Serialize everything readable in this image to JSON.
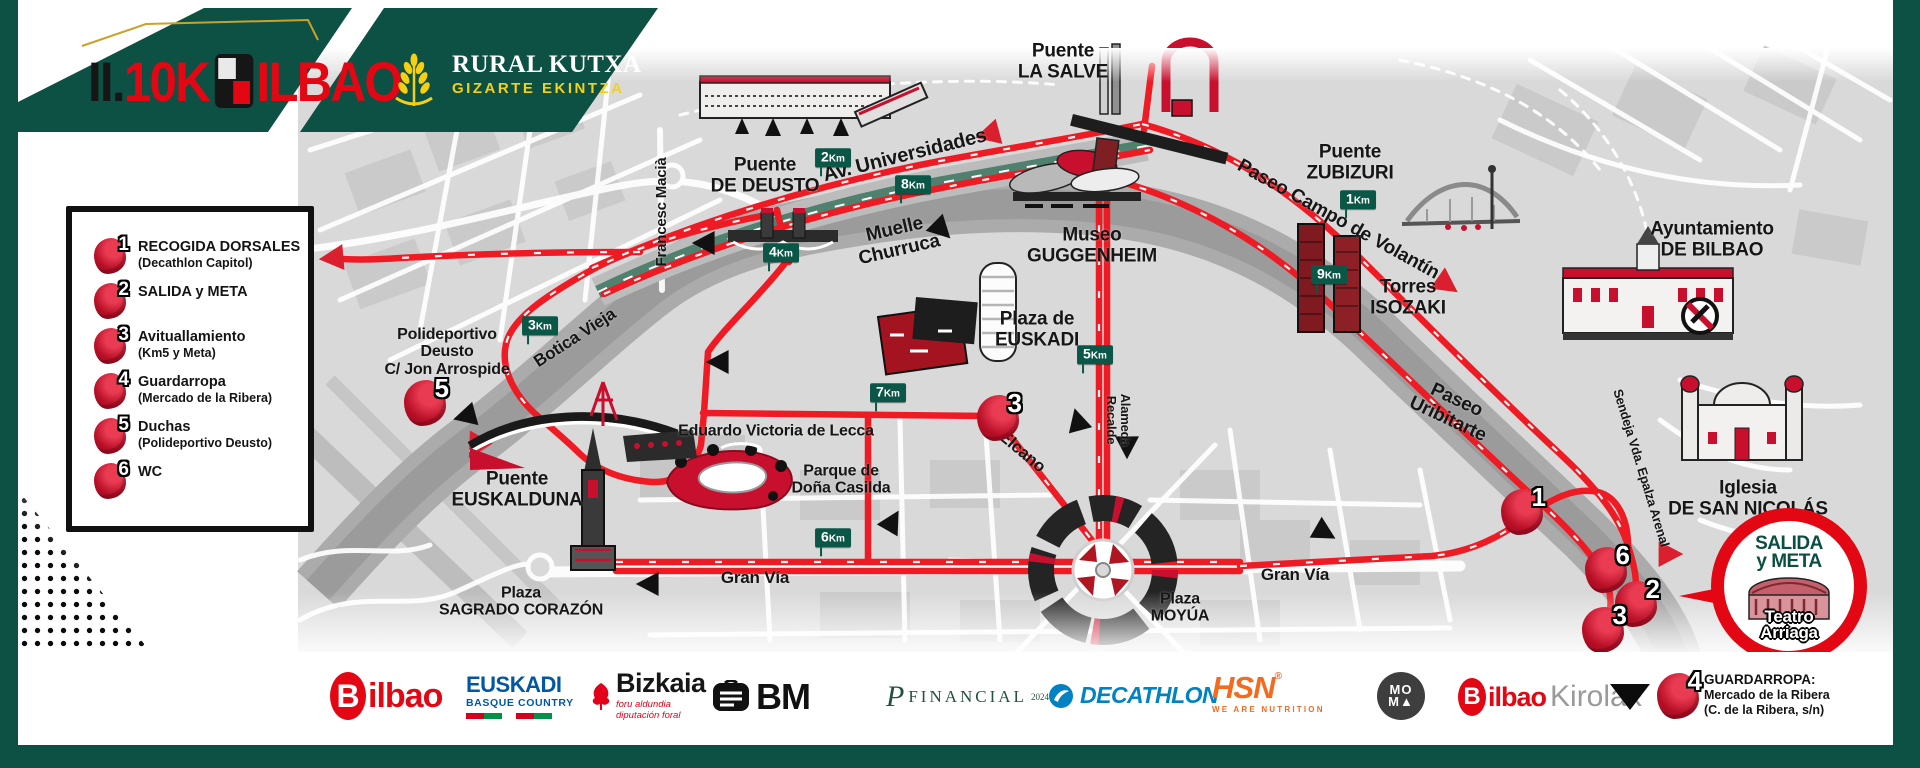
{
  "colors": {
    "green": "#0d5044",
    "kmgreen": "#0a5748",
    "red": "#e30613",
    "routeRed": "#ee1b24",
    "markerRed": "#bf0f23",
    "mapbg": "#d9d9d9",
    "river": "#a9a9a9",
    "gold": "#c9a227",
    "yellow": "#f1d11c"
  },
  "header": {
    "roman": "II.",
    "distance": "10K",
    "city": "ILBAO",
    "rural": {
      "name": "RURAL KUTXA",
      "sub": "GIZARTE EKINTZA"
    }
  },
  "legend": {
    "items": [
      {
        "num": "1",
        "title": "RECOGIDA DORSALES",
        "sub": "(Decathlon Capitol)"
      },
      {
        "num": "2",
        "title": "SALIDA y META",
        "sub": ""
      },
      {
        "num": "3",
        "title": "Avituallamiento",
        "sub": "(Km5 y Meta)"
      },
      {
        "num": "4",
        "title": "Guardarropa",
        "sub": "(Mercado de la Ribera)"
      },
      {
        "num": "5",
        "title": "Duchas",
        "sub": "(Polideportivo Deusto)"
      },
      {
        "num": "6",
        "title": "WC",
        "sub": ""
      }
    ]
  },
  "map": {
    "labels": [
      {
        "text": "Puente\nDE DEUSTO",
        "x": 765,
        "y": 176,
        "size": 19,
        "rot": 0
      },
      {
        "text": "Av. Universidades",
        "x": 905,
        "y": 156,
        "size": 20,
        "rot": -14
      },
      {
        "text": "Puente\nLA SALVE",
        "x": 1063,
        "y": 62,
        "size": 19,
        "rot": 0
      },
      {
        "text": "Museo\nGUGGENHEIM",
        "x": 1092,
        "y": 246,
        "size": 19,
        "rot": 0
      },
      {
        "text": "Puente\nZUBIZURI",
        "x": 1350,
        "y": 163,
        "size": 19,
        "rot": 0
      },
      {
        "text": "Paseo Campo de Volantín",
        "x": 1338,
        "y": 220,
        "size": 19,
        "rot": 29
      },
      {
        "text": "Ayuntamiento\nDE BILBAO",
        "x": 1712,
        "y": 240,
        "size": 19,
        "rot": 0
      },
      {
        "text": "Torres\nISOZAKI",
        "x": 1408,
        "y": 298,
        "size": 19,
        "rot": 0
      },
      {
        "text": "Iglesia\nDE SAN NICOLÁS",
        "x": 1748,
        "y": 499,
        "size": 19,
        "rot": 0
      },
      {
        "text": "Sendeja  Vda. Epalza  Arenal",
        "x": 1641,
        "y": 468,
        "size": 13,
        "rot": 73
      },
      {
        "text": "Paseo\nUribitarte",
        "x": 1452,
        "y": 410,
        "size": 19,
        "rot": 25
      },
      {
        "text": "Muelle\nChurruca",
        "x": 897,
        "y": 240,
        "size": 19,
        "rot": -13
      },
      {
        "text": "Francesc Macià",
        "x": 662,
        "y": 212,
        "size": 15,
        "rot": -90
      },
      {
        "text": "Botica Vieja",
        "x": 575,
        "y": 338,
        "size": 17,
        "rot": -33
      },
      {
        "text": "Polideportivo\nDeusto\nC/ Jon Arrospide",
        "x": 447,
        "y": 352,
        "size": 16,
        "rot": 0
      },
      {
        "text": "Puente\nEUSKALDUNA",
        "x": 517,
        "y": 490,
        "size": 19,
        "rot": 0
      },
      {
        "text": "Eduardo Victoria de Lecca",
        "x": 776,
        "y": 431,
        "size": 16,
        "rot": 0
      },
      {
        "text": "Parque de\nDoña Casilda",
        "x": 841,
        "y": 480,
        "size": 16,
        "rot": 0
      },
      {
        "text": "Plaza\nSAGRADO CORAZÓN",
        "x": 521,
        "y": 602,
        "size": 16,
        "rot": 0
      },
      {
        "text": "Gran Vía",
        "x": 755,
        "y": 578,
        "size": 17,
        "rot": 0
      },
      {
        "text": "Plaza\nMOYÚA",
        "x": 1180,
        "y": 608,
        "size": 16,
        "rot": 0
      },
      {
        "text": "Gran Vía",
        "x": 1295,
        "y": 575,
        "size": 17,
        "rot": 0
      },
      {
        "text": "Elcano",
        "x": 1022,
        "y": 452,
        "size": 17,
        "rot": 40
      },
      {
        "text": "Alameda\nRecalde",
        "x": 1118,
        "y": 420,
        "size": 13,
        "rot": 90
      },
      {
        "text": "Plaza de\nEUSKADI",
        "x": 1037,
        "y": 330,
        "size": 19,
        "rot": 0
      }
    ],
    "km_markers": [
      {
        "label": "1Km",
        "x": 1358,
        "y": 200
      },
      {
        "label": "2Km",
        "x": 833,
        "y": 158
      },
      {
        "label": "3Km",
        "x": 540,
        "y": 326
      },
      {
        "label": "4Km",
        "x": 781,
        "y": 253
      },
      {
        "label": "5Km",
        "x": 1095,
        "y": 355
      },
      {
        "label": "6Km",
        "x": 833,
        "y": 538
      },
      {
        "label": "7Km",
        "x": 888,
        "y": 393
      },
      {
        "label": "8Km",
        "x": 913,
        "y": 185
      },
      {
        "label": "9Km",
        "x": 1329,
        "y": 275
      }
    ],
    "point_markers": [
      {
        "num": "5",
        "x": 425,
        "y": 403
      },
      {
        "num": "3",
        "x": 998,
        "y": 418
      },
      {
        "num": "1",
        "x": 1522,
        "y": 512
      },
      {
        "num": "6",
        "x": 1606,
        "y": 570
      },
      {
        "num": "2",
        "x": 1636,
        "y": 604
      },
      {
        "num": "3",
        "x": 1603,
        "y": 630
      }
    ],
    "finish": {
      "line1": "SALIDA",
      "line2": "y META",
      "venue": "Teatro\nArriaga"
    }
  },
  "footer": {
    "bilbao": {
      "b": "B",
      "rest": "ilbao"
    },
    "euskadi": {
      "line1": "EUSKADI",
      "line2": "BASQUE COUNTRY"
    },
    "bizkaia": {
      "name": "Bizkaia",
      "sub1": "foru aldundia",
      "sub2": "diputación foral"
    },
    "bm": {
      "text": "BM"
    },
    "financial": {
      "p": "P",
      "name": "FINANCIAL",
      "year": "2024"
    },
    "decathlon": {
      "text": "DECATHLON"
    },
    "hsn": {
      "text": "HSN",
      "reg": "®",
      "sub": "WE ARE NUTRITION"
    },
    "moma": {
      "line1": "MO",
      "line2": "M▲"
    },
    "kirolak": {
      "b": "B",
      "rest": "ilbao",
      "suffix": "Kirolak"
    },
    "guardarropa": {
      "num": "4",
      "line1": "GUARDARROPA:",
      "line2": "Mercado de la Ribera",
      "line3": "(C. de la Ribera, s/n)"
    }
  }
}
